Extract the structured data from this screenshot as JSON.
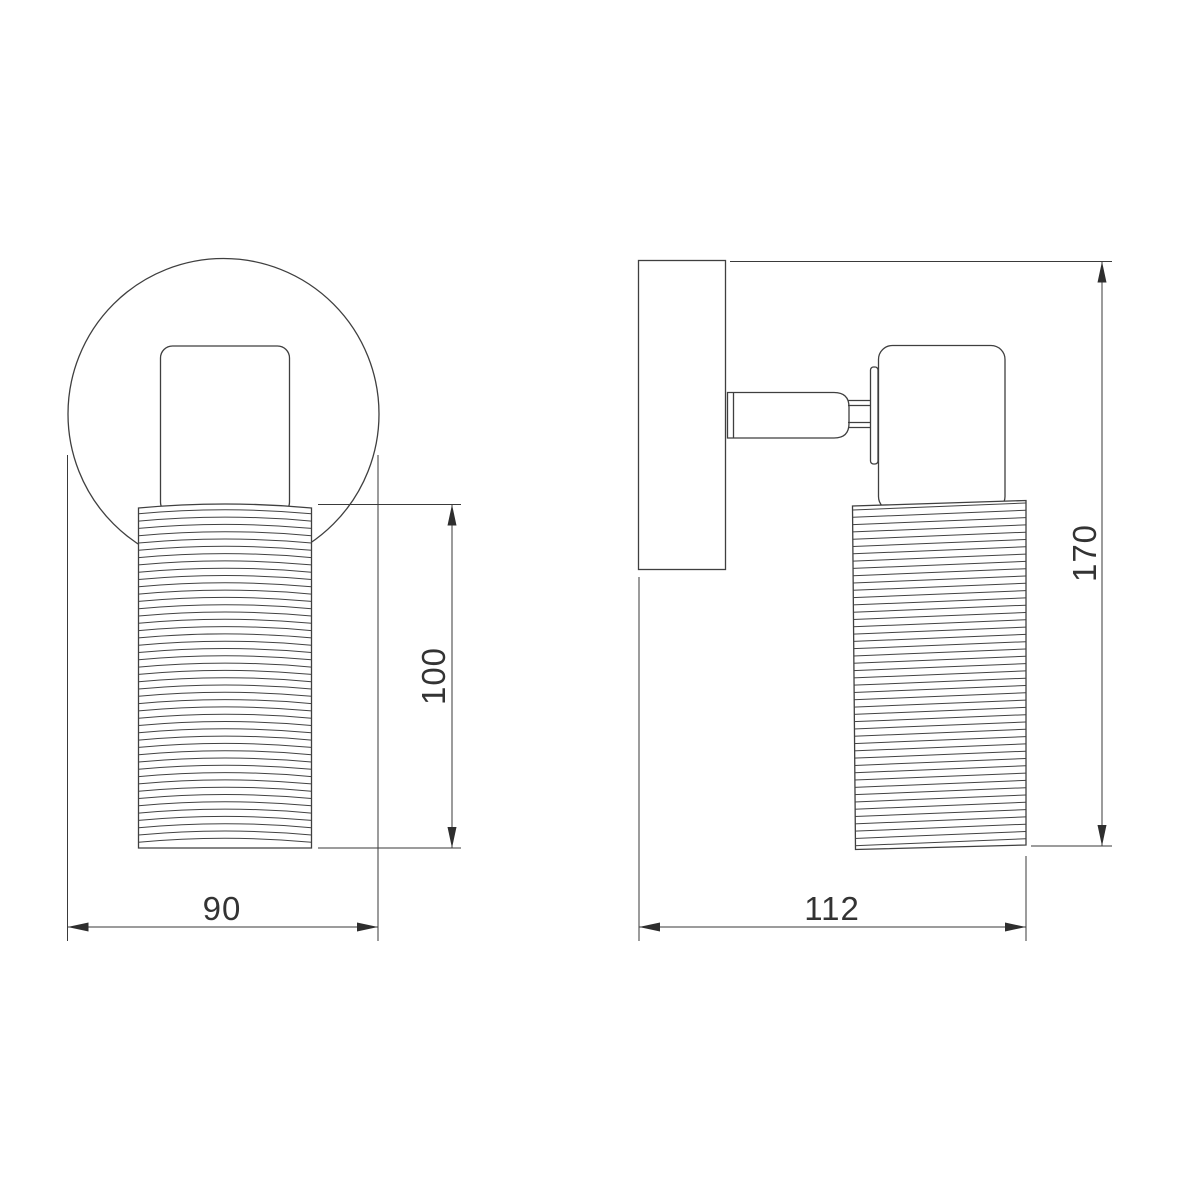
{
  "views": {
    "front": {
      "dimensions": {
        "width": {
          "label": "90"
        },
        "shade_height": {
          "label": "100"
        }
      }
    },
    "side": {
      "dimensions": {
        "depth": {
          "label": "112"
        },
        "height": {
          "label": "170"
        }
      }
    }
  },
  "colors": {
    "line": "#3f3f3f",
    "dimension_line": "#3a3a3a",
    "text": "#333333",
    "background": "#ffffff"
  }
}
